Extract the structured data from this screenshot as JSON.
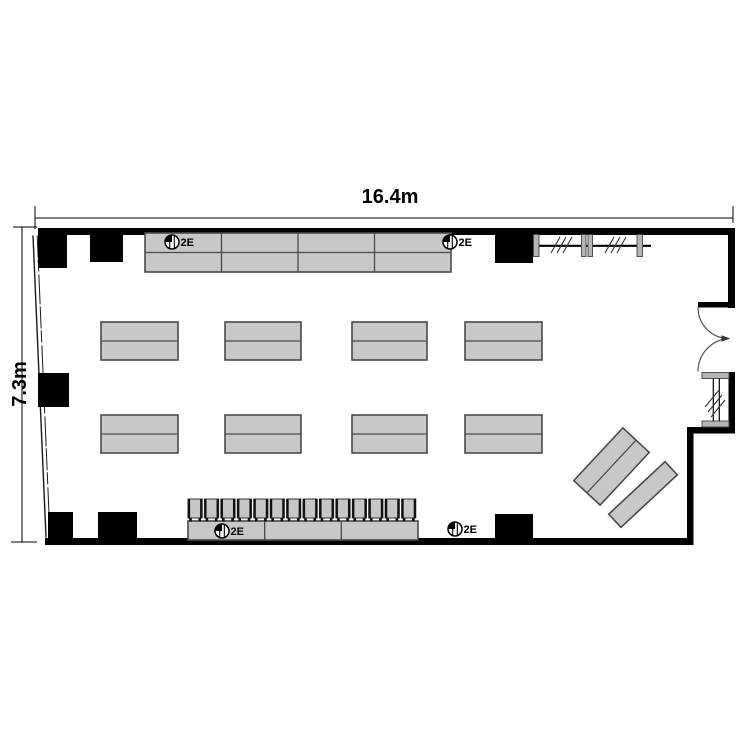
{
  "colors": {
    "background": "#ffffff",
    "ink": "#000000",
    "table_fill": "#c8c8c8",
    "table_stroke": "#4a4a4a",
    "chair_fill": "#c6c6c6",
    "mullion_fill": "#b5b5b5"
  },
  "dimension_labels": {
    "width": "16.4m",
    "height": "7.3m"
  },
  "extinguishers": [
    {
      "label": "2E",
      "cx": 172,
      "cy": 242
    },
    {
      "label": "2E",
      "cx": 450,
      "cy": 242
    },
    {
      "label": "2E",
      "cy": 531,
      "cx": 222
    },
    {
      "label": "2E",
      "cx": 455,
      "cy": 529
    }
  ],
  "floorplan": {
    "columns": [
      [
        38,
        228,
        29,
        40
      ],
      [
        90,
        228,
        33,
        34
      ],
      [
        495,
        228,
        38,
        35
      ],
      [
        38,
        373,
        31,
        34
      ],
      [
        48,
        512,
        25,
        28
      ],
      [
        98,
        512,
        39,
        28
      ],
      [
        495,
        514,
        38,
        26
      ]
    ],
    "table_blocks": {
      "top": {
        "x": 145,
        "y": 233,
        "w": 306,
        "h": 39,
        "cols": 4,
        "rows": 2
      },
      "bottom": {
        "x": 188,
        "y": 521,
        "w": 230,
        "h": 19,
        "cols": 3,
        "rows": 1
      },
      "middle": {
        "rows_y": [
          322,
          415
        ],
        "xs": [
          101,
          225,
          352,
          465
        ],
        "ws": [
          77,
          76,
          75,
          77
        ],
        "h": 38
      }
    },
    "chairs": {
      "count": 14,
      "x": 188,
      "step": 16.43,
      "w": 14.2,
      "y": 499,
      "h": 19
    },
    "diagonal_tables": [
      {
        "cx": 611.5,
        "cy": 466.5,
        "w": 72,
        "h": 36,
        "rot": -47,
        "split": true
      },
      {
        "cx": 643,
        "cy": 494.5,
        "w": 77,
        "h": 18,
        "rot": -43,
        "split": false
      }
    ]
  }
}
